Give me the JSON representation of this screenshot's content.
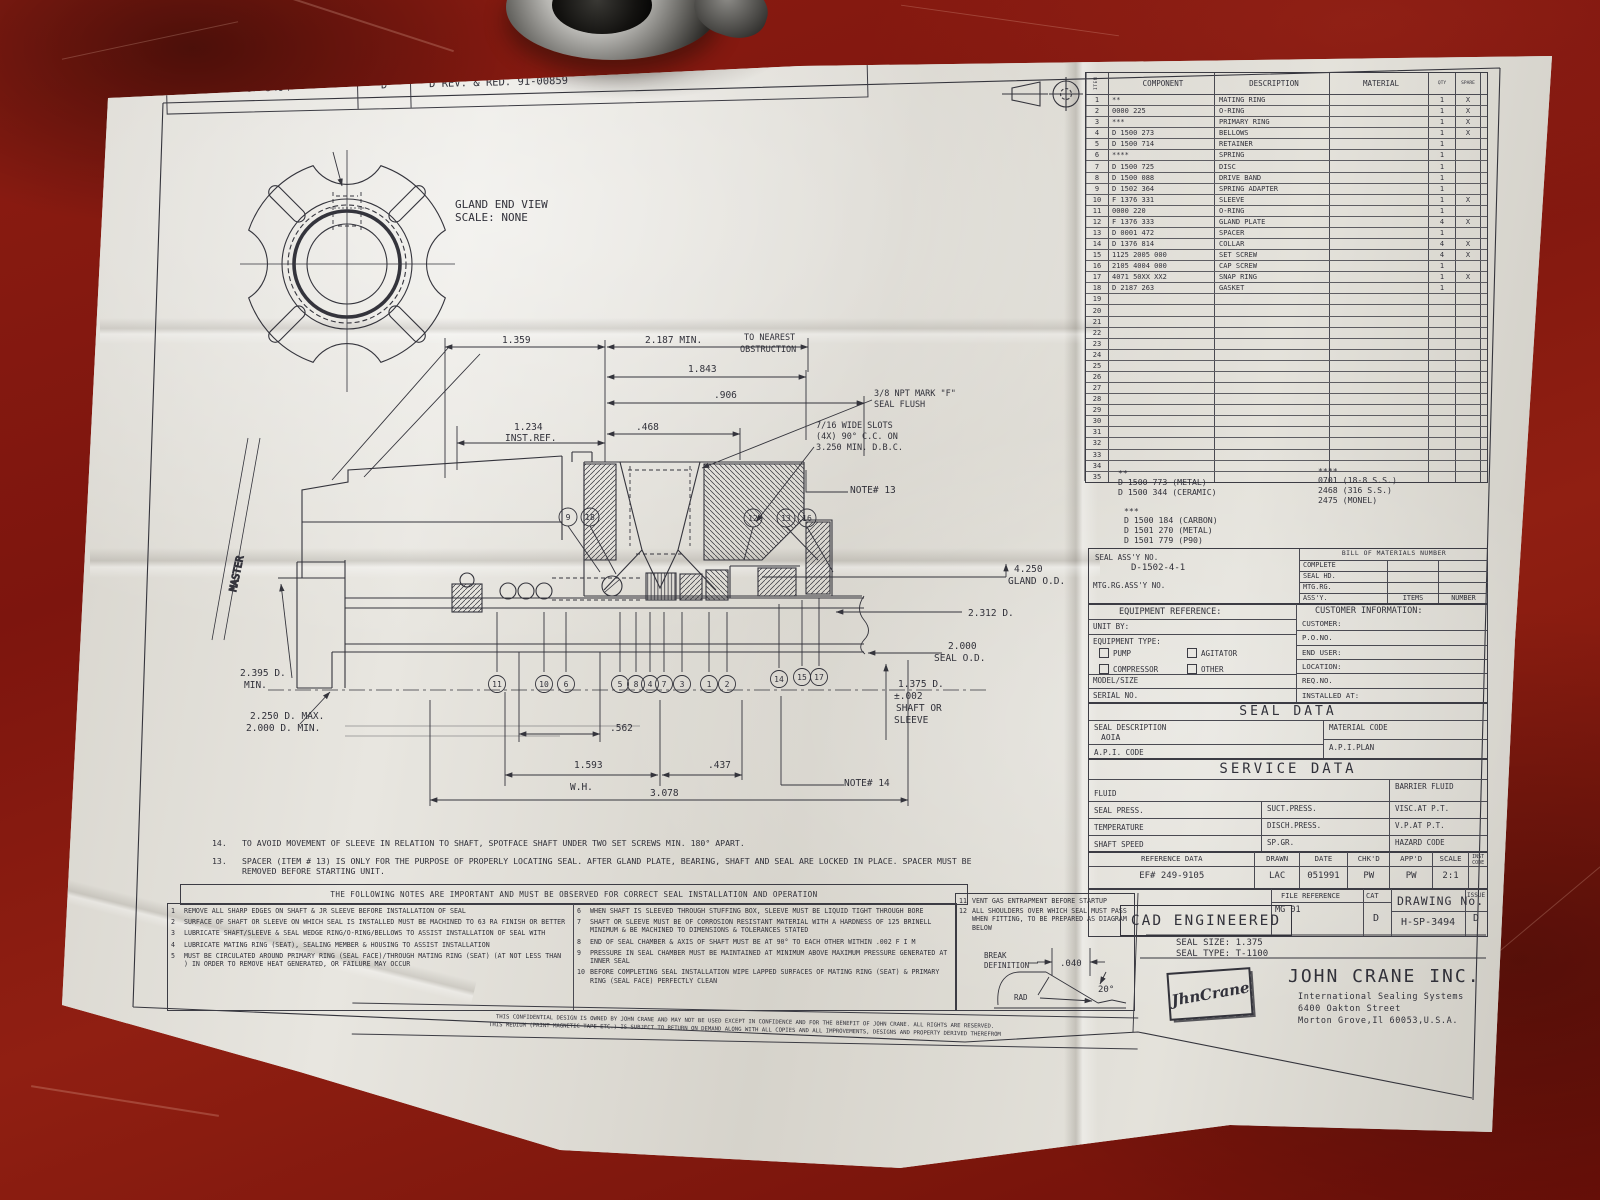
{
  "revision": {
    "number": "H-SP-3494",
    "rev": "D",
    "desc": "D REV. & RED. 91-00859"
  },
  "master_label": "MASTER",
  "gland_view": {
    "title": "GLAND END VIEW",
    "scale": "SCALE: NONE"
  },
  "parts_table": {
    "headers": {
      "item": "ITEM",
      "component": "COMPONENT",
      "description": "DESCRIPTION",
      "material": "MATERIAL",
      "qty": "QTY",
      "spare": "SPARE"
    },
    "rows": [
      {
        "item": "1",
        "component": "**",
        "description": "MATING RING",
        "material": "",
        "qty": "1",
        "spare": "X"
      },
      {
        "item": "2",
        "component": "0000 225",
        "description": "O-RING",
        "material": "",
        "qty": "1",
        "spare": "X"
      },
      {
        "item": "3",
        "component": "***",
        "description": "PRIMARY RING",
        "material": "",
        "qty": "1",
        "spare": "X"
      },
      {
        "item": "4",
        "component": "D 1500 273",
        "description": "BELLOWS",
        "material": "",
        "qty": "1",
        "spare": "X"
      },
      {
        "item": "5",
        "component": "D 1500 714",
        "description": "RETAINER",
        "material": "",
        "qty": "1",
        "spare": ""
      },
      {
        "item": "6",
        "component": "****",
        "description": "SPRING",
        "material": "",
        "qty": "1",
        "spare": ""
      },
      {
        "item": "7",
        "component": "D 1500 725",
        "description": "DISC",
        "material": "",
        "qty": "1",
        "spare": ""
      },
      {
        "item": "8",
        "component": "D 1500 088",
        "description": "DRIVE BAND",
        "material": "",
        "qty": "1",
        "spare": ""
      },
      {
        "item": "9",
        "component": "D 1502 364",
        "description": "SPRING ADAPTER",
        "material": "",
        "qty": "1",
        "spare": ""
      },
      {
        "item": "10",
        "component": "F 1376 331",
        "description": "SLEEVE",
        "material": "",
        "qty": "1",
        "spare": "X"
      },
      {
        "item": "11",
        "component": "0000 220",
        "description": "O-RING",
        "material": "",
        "qty": "1",
        "spare": ""
      },
      {
        "item": "12",
        "component": "F 1376 333",
        "description": "GLAND PLATE",
        "material": "",
        "qty": "4",
        "spare": "X"
      },
      {
        "item": "13",
        "component": "D 0001 472",
        "description": "SPACER",
        "material": "",
        "qty": "1",
        "spare": ""
      },
      {
        "item": "14",
        "component": "D 1376 814",
        "description": "COLLAR",
        "material": "",
        "qty": "4",
        "spare": "X"
      },
      {
        "item": "15",
        "component": "1125 2005 000",
        "description": "SET SCREW",
        "material": "",
        "qty": "4",
        "spare": "X"
      },
      {
        "item": "16",
        "component": "2105 4004 000",
        "description": "CAP SCREW",
        "material": "",
        "qty": "1",
        "spare": ""
      },
      {
        "item": "17",
        "component": "4071 50XX XX2",
        "description": "SNAP RING",
        "material": "",
        "qty": "1",
        "spare": "X"
      },
      {
        "item": "18",
        "component": "D 2187 263",
        "description": "GASKET",
        "material": "",
        "qty": "1",
        "spare": ""
      },
      {
        "item": "19",
        "component": "",
        "description": "",
        "material": "",
        "qty": "",
        "spare": ""
      },
      {
        "item": "20",
        "component": "",
        "description": "",
        "material": "",
        "qty": "",
        "spare": ""
      },
      {
        "item": "21",
        "component": "",
        "description": "",
        "material": "",
        "qty": "",
        "spare": ""
      },
      {
        "item": "22",
        "component": "",
        "description": "",
        "material": "",
        "qty": "",
        "spare": ""
      },
      {
        "item": "23",
        "component": "",
        "description": "",
        "material": "",
        "qty": "",
        "spare": ""
      },
      {
        "item": "24",
        "component": "",
        "description": "",
        "material": "",
        "qty": "",
        "spare": ""
      },
      {
        "item": "25",
        "component": "",
        "description": "",
        "material": "",
        "qty": "",
        "spare": ""
      },
      {
        "item": "26",
        "component": "",
        "description": "",
        "material": "",
        "qty": "",
        "spare": ""
      },
      {
        "item": "27",
        "component": "",
        "description": "",
        "material": "",
        "qty": "",
        "spare": ""
      },
      {
        "item": "28",
        "component": "",
        "description": "",
        "material": "",
        "qty": "",
        "spare": ""
      },
      {
        "item": "29",
        "component": "",
        "description": "",
        "material": "",
        "qty": "",
        "spare": ""
      },
      {
        "item": "30",
        "component": "",
        "description": "",
        "material": "",
        "qty": "",
        "spare": ""
      },
      {
        "item": "31",
        "component": "",
        "description": "",
        "material": "",
        "qty": "",
        "spare": ""
      },
      {
        "item": "32",
        "component": "",
        "description": "",
        "material": "",
        "qty": "",
        "spare": ""
      },
      {
        "item": "33",
        "component": "",
        "description": "",
        "material": "",
        "qty": "",
        "spare": ""
      },
      {
        "item": "34",
        "component": "",
        "description": "",
        "material": "",
        "qty": "",
        "spare": ""
      },
      {
        "item": "35",
        "component": "",
        "description": "",
        "material": "",
        "qty": "",
        "spare": ""
      }
    ]
  },
  "material_codes": {
    "mark2": "**",
    "mark2_lines": [
      "D 1500 773 (METAL)",
      "D 1500 344 (CERAMIC)"
    ],
    "mark3": "***",
    "mark3_lines": [
      "D 1500 184 (CARBON)",
      "D 1501 270 (METAL)",
      "D 1501 779 (P90)"
    ],
    "mark4": "****",
    "mark4_lines": [
      "0701 (18-8 S.S.)",
      "2468 (316 S.S.)",
      "2475 (MONEL)"
    ]
  },
  "assembly": {
    "seal_assy_label": "SEAL ASS'Y NO.",
    "seal_assy_no": "D-1502-4-1",
    "mtg_label": "MTG.RG.ASS'Y NO.",
    "bom_title": "BILL OF MATERIALS NUMBER",
    "bom_rows": [
      "COMPLETE",
      "SEAL HD.",
      "MTG.RG.",
      "ASS'Y."
    ],
    "items_label": "ITEMS",
    "number_label": "NUMBER"
  },
  "equipment": {
    "title": "EQUIPMENT REFERENCE:",
    "unit_by": "UNIT BY:",
    "type_label": "EQUIPMENT TYPE:",
    "checkboxes": [
      "PUMP",
      "AGITATOR",
      "COMPRESSOR",
      "OTHER"
    ],
    "model": "MODEL/SIZE",
    "serial": "SERIAL NO."
  },
  "customer": {
    "title": "CUSTOMER INFORMATION:",
    "rows": [
      "CUSTOMER:",
      "P.O.NO.",
      "END USER:",
      "LOCATION:",
      "REQ.NO.",
      "INSTALLED AT:"
    ]
  },
  "seal_data": {
    "title": "SEAL DATA",
    "desc_label": "SEAL DESCRIPTION",
    "desc_value": "AOIA",
    "material_code": "MATERIAL CODE",
    "api_code": "A.P.I. CODE",
    "api_plan": "A.P.I.PLAN"
  },
  "service_data": {
    "title": "SERVICE DATA",
    "fluid": "FLUID",
    "barrier": "BARRIER FLUID",
    "seal_press": "SEAL PRESS.",
    "suct": "SUCT.PRESS.",
    "visc": "VISC.AT P.T.",
    "temp": "TEMPERATURE",
    "disch": "DISCH.PRESS.",
    "vp": "V.P.AT P.T.",
    "shaft_speed": "SHAFT SPEED",
    "spgr": "SP.GR.",
    "hazard": "HAZARD CODE"
  },
  "reference": {
    "headers": [
      "REFERENCE DATA",
      "DRAWN",
      "DATE",
      "CHK'D",
      "APP'D",
      "SCALE",
      "INST CODE"
    ],
    "values": [
      "EF# 249-9105",
      "LAC",
      "051991",
      "PW",
      "PW",
      "2:1",
      ""
    ],
    "file_ref_label": "FILE REFERENCE",
    "file_ref": "MG 01",
    "cat_label": "CAT",
    "cat": "D",
    "drawing_no_label": "DRAWING No.",
    "drawing_no": "H-SP-3494",
    "issue_label": "ISSUE",
    "issue": "D"
  },
  "cad": {
    "stamp": "CAD ENGINEERED",
    "seal_size": "SEAL SIZE: 1.375",
    "seal_type": "SEAL TYPE: T-1100"
  },
  "company": {
    "logo": "JhnCrane",
    "name": "JOHN CRANE INC.",
    "line1": "International Sealing Systems",
    "line2": "6400 Oakton Street",
    "line3": "Morton Grove,Il 60053,U.S.A."
  },
  "notes": {
    "upper": [
      {
        "num": "14.",
        "text": "TO AVOID MOVEMENT OF SLEEVE IN RELATION TO SHAFT, SPOTFACE SHAFT UNDER TWO SET SCREWS MIN. 180° APART."
      },
      {
        "num": "13.",
        "text": "SPACER (ITEM # 13) IS ONLY FOR THE PURPOSE OF PROPERLY LOCATING SEAL. AFTER GLAND PLATE, BEARING, SHAFT AND SEAL ARE LOCKED IN PLACE. SPACER MUST BE REMOVED BEFORE STARTING UNIT."
      }
    ],
    "banner": "THE FOLLOWING NOTES ARE IMPORTANT AND MUST BE OBSERVED FOR CORRECT SEAL INSTALLATION AND OPERATION",
    "col1": [
      {
        "num": "1",
        "text": "REMOVE ALL SHARP EDGES ON SHAFT & JR SLEEVE BEFORE INSTALLATION OF SEAL"
      },
      {
        "num": "2",
        "text": "SURFACE OF SHAFT OR SLEEVE ON WHICH SEAL IS INSTALLED MUST BE MACHINED TO 63 RA FINISH OR BETTER"
      },
      {
        "num": "3",
        "text": "LUBRICATE SHAFT/SLEEVE & SEAL WEDGE RING/O-RING/BELLOWS TO ASSIST INSTALLATION OF SEAL WITH"
      },
      {
        "num": "4",
        "text": "LUBRICATE MATING RING (SEAT), SEALING MEMBER & HOUSING TO ASSIST INSTALLATION"
      },
      {
        "num": "5",
        "text": "MUST BE CIRCULATED AROUND PRIMARY RING (SEAL FACE)/THROUGH MATING RING (SEAT) (AT NOT LESS THAN ) IN ORDER TO REMOVE HEAT GENERATED, OR FAILURE MAY OCCUR"
      }
    ],
    "col2": [
      {
        "num": "6",
        "text": "WHEN SHAFT IS SLEEVED THROUGH STUFFING BOX, SLEEVE MUST BE LIQUID TIGHT THROUGH BORE"
      },
      {
        "num": "7",
        "text": "SHAFT OR SLEEVE MUST BE OF CORROSION RESISTANT MATERIAL WITH A HARDNESS OF 125 BRINELL MINIMUM & BE MACHINED TO DIMENSIONS & TOLERANCES STATED"
      },
      {
        "num": "8",
        "text": "END OF SEAL CHAMBER & AXIS OF SHAFT MUST BE AT 90° TO EACH OTHER WITHIN .002 F I M"
      },
      {
        "num": "9",
        "text": "PRESSURE IN SEAL CHAMBER MUST BE MAINTAINED AT MINIMUM ABOVE MAXIMUM PRESSURE GENERATED AT INNER SEAL"
      },
      {
        "num": "10",
        "text": "BEFORE COMPLETING SEAL INSTALLATION WIPE LAPPED SURFACES OF MATING RING (SEAT) & PRIMARY RING (SEAL FACE) PERFECTLY CLEAN"
      }
    ],
    "col3": [
      {
        "num": "11",
        "text": "VENT GAS ENTRAPMENT BEFORE STARTUP"
      },
      {
        "num": "12",
        "text": "ALL SHOULDERS OVER WHICH SEAL MUST PASS WHEN FITTING, TO BE PREPARED AS DIAGRAM BELOW"
      }
    ],
    "break_def": {
      "label1": "BREAK",
      "label2": "DEFINITION",
      "dim": ".040",
      "angle": "20°",
      "rad": "RAD"
    }
  },
  "confidential": {
    "line1": "THIS CONFIDENTIAL DESIGN IS OWNED BY JOHN CRANE AND MAY NOT BE USED EXCEPT IN CONFIDENCE AND FOR THE BENEFIT OF JOHN CRANE. ALL RIGHTS ARE RESERVED.",
    "line2": "THIS MEDIUM (PRINT MAGNETIC TAPE ETC.) IS SUBJECT TO RETURN ON DEMAND ALONG WITH ALL COPIES AND ALL IMPROVEMENTS, DESIGNS AND PROPERTY DERIVED THEREFROM"
  },
  "dims": {
    "d1359": "1.359",
    "d2187": "2.187 MIN.",
    "near1": "TO NEAREST",
    "near2": "OBSTRUCTION",
    "d1843": "1.843",
    "d906": ".906",
    "npt1": "3/8 NPT MARK \"F\"",
    "npt2": "SEAL FLUSH",
    "d468": ".468",
    "d1234": "1.234",
    "instref": "INST.REF.",
    "slots1": "7/16 WIDE SLOTS",
    "slots2": "(4X) 90° C.C. ON",
    "slots3": "3.250 MIN. D.B.C.",
    "note13": "NOTE# 13",
    "note14": "NOTE# 14",
    "gland1": "4.250",
    "gland2": "GLAND O.D.",
    "d2312": "2.312 D.",
    "sealod1": "2.000",
    "sealod2": "SEAL O.D.",
    "shaft1": "1.375 D.",
    "shaft2": "±.002",
    "shaft3": "SHAFT OR",
    "shaft4": "SLEEVE",
    "d2395a": "2.395 D.",
    "d2395b": "MIN.",
    "d2250": "2.250 D. MAX.",
    "d2000": "2.000 D. MIN.",
    "d562": ".562",
    "d1593": "1.593",
    "wh": "W.H.",
    "d437": ".437",
    "d3078": "3.078"
  },
  "balloons": {
    "b1": "1",
    "b2": "2",
    "b3": "3",
    "b4": "4",
    "b5": "5",
    "b6": "6",
    "b7": "7",
    "b8": "8",
    "b9": "9",
    "b10": "10",
    "b11": "11",
    "b12": "12",
    "b13": "13",
    "b14": "14",
    "b15": "15",
    "b16": "16",
    "b17": "17",
    "b18": "18"
  }
}
